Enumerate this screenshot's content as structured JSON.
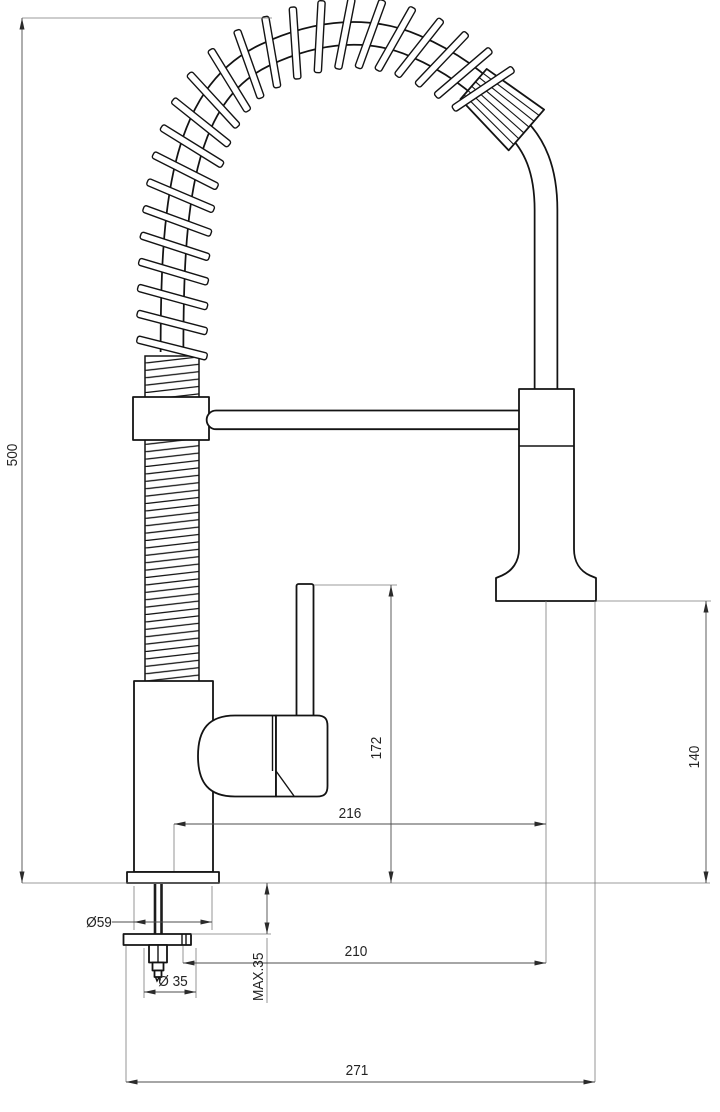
{
  "drawing": {
    "subject": "kitchen-faucet-with-spring-spout-dimension-drawing",
    "dims": {
      "overall_height": "500",
      "handle_top_height": "172",
      "outlet_height": "140",
      "reach_to_spout_axis_upper": "216",
      "reach_to_spout_axis_lower": "210",
      "overall_reach": "271",
      "base_diameter": "Ø59",
      "hole_diameter": "Ø 35",
      "max_deck_thickness": "MAX.35"
    }
  }
}
